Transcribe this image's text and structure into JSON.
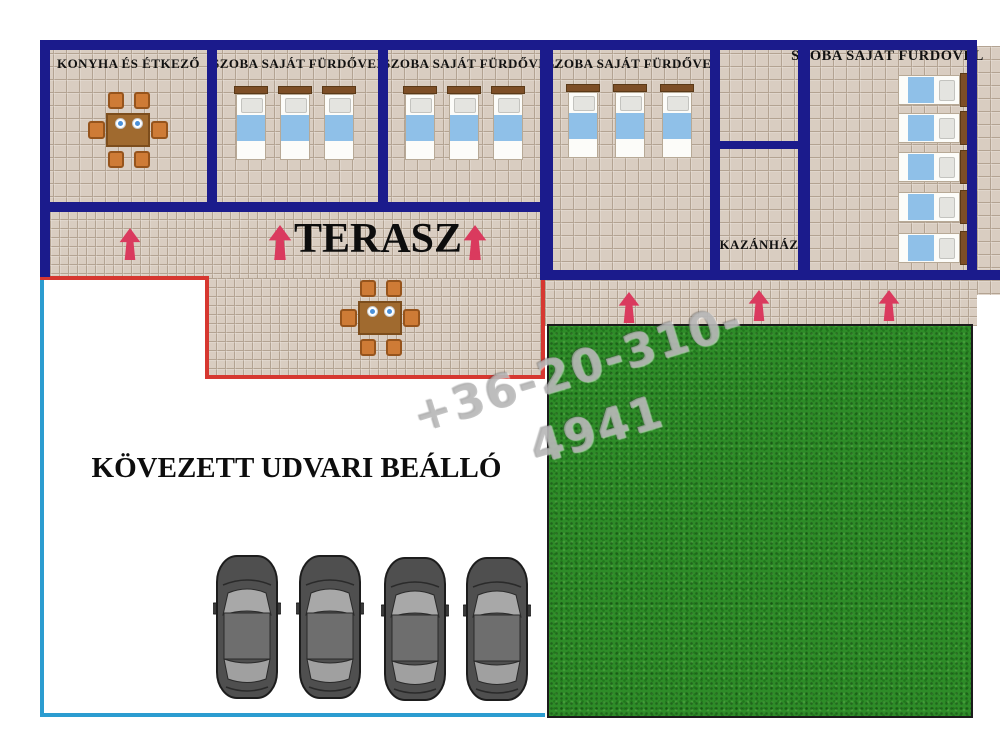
{
  "plan_type": "floor-plan",
  "rooms": {
    "kitchen": {
      "label": "KONYHA ÉS ÉTKEZŐ",
      "furniture": "dining table with 6 chairs"
    },
    "room1": {
      "label": "SZOBA SAJÁT FÜRDŐVEL",
      "beds": 3
    },
    "room2": {
      "label": "SZOBA SAJÁT FÜRDŐVEL",
      "beds": 3
    },
    "room3": {
      "label": "SZOBA SAJÁT FÜRDŐVEL",
      "beds": 3
    },
    "room4": {
      "label": "SZOBA SAJÁT FÜRDŐVEL",
      "beds": 5
    },
    "boiler": {
      "label": "KAZÁNHÁZ"
    }
  },
  "areas": {
    "terrace": {
      "label": "TERASZ",
      "furniture": "dining table with 6 chairs"
    },
    "parking": {
      "label": "KÖVEZETT UDVARI BEÁLLÓ",
      "cars": 4
    },
    "lawn": {
      "label": ""
    }
  },
  "watermark": {
    "text": "+36-20-310-4941"
  },
  "icons": {
    "entrance_arrows": 6
  },
  "colors": {
    "wall": "#1b1b8c",
    "tile": "#d9cdc1",
    "tile_grid": "#b3a392",
    "grass": "#2e8c28",
    "terrace_border": "#d63730",
    "parking_border": "#2b9cd0",
    "arrow": "#da3a5e",
    "bed_blanket": "#8fc0e8",
    "bed_frame": "#7d4e26",
    "table": "#a06a2f",
    "chair": "#ce7b36",
    "label_text": "#111111"
  }
}
